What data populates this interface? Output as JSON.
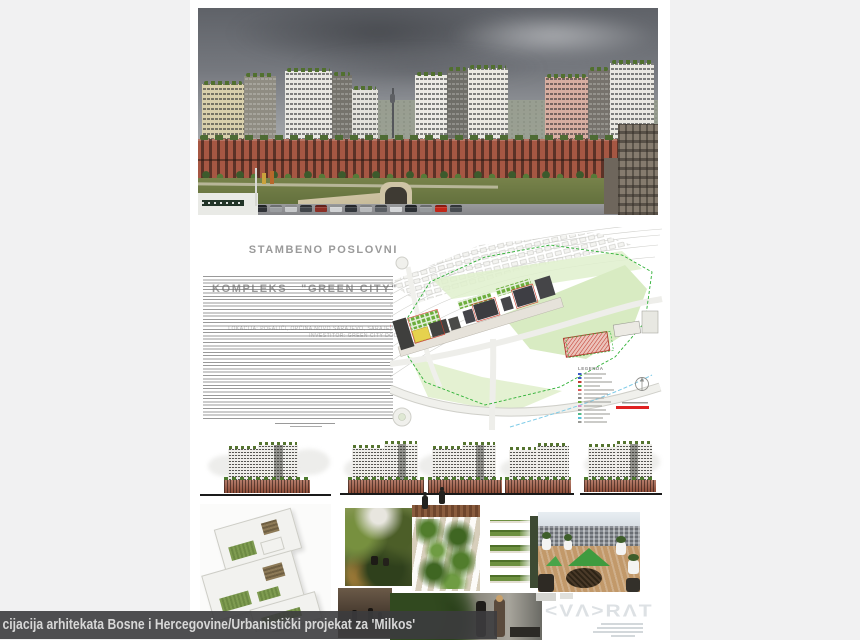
{
  "window": {
    "background": "#f1f1f2"
  },
  "caption": {
    "text": "cijacija arhitekata Bosne i Hercegovine/Urbanistički projekat za 'Milkos'"
  },
  "poster": {
    "header": {
      "title_line1": "STAMBENO POSLOVNI",
      "title_line2": "KOMPLEKS   \"GREEN CITY\"",
      "location_line": "LOKACIJA: POFALIĆI, OPĆINA NOVO SARAJEVO, SARAJEVO",
      "investor_line": "INVESTITOR: GREEN CITY DOO"
    },
    "site_plan": {
      "legend_title": "LEGENDA"
    },
    "logo": {
      "text": "KVADRAT",
      "display": "<VΛ>RΛT"
    },
    "accent_colors": {
      "terracotta": "#a05841",
      "roof_green": "#4e7a2e",
      "plan_boundary_green": "#2eb135",
      "plan_yellow": "#e6d24e",
      "plan_red": "#c23b2e",
      "scale_red": "#e02222"
    }
  }
}
